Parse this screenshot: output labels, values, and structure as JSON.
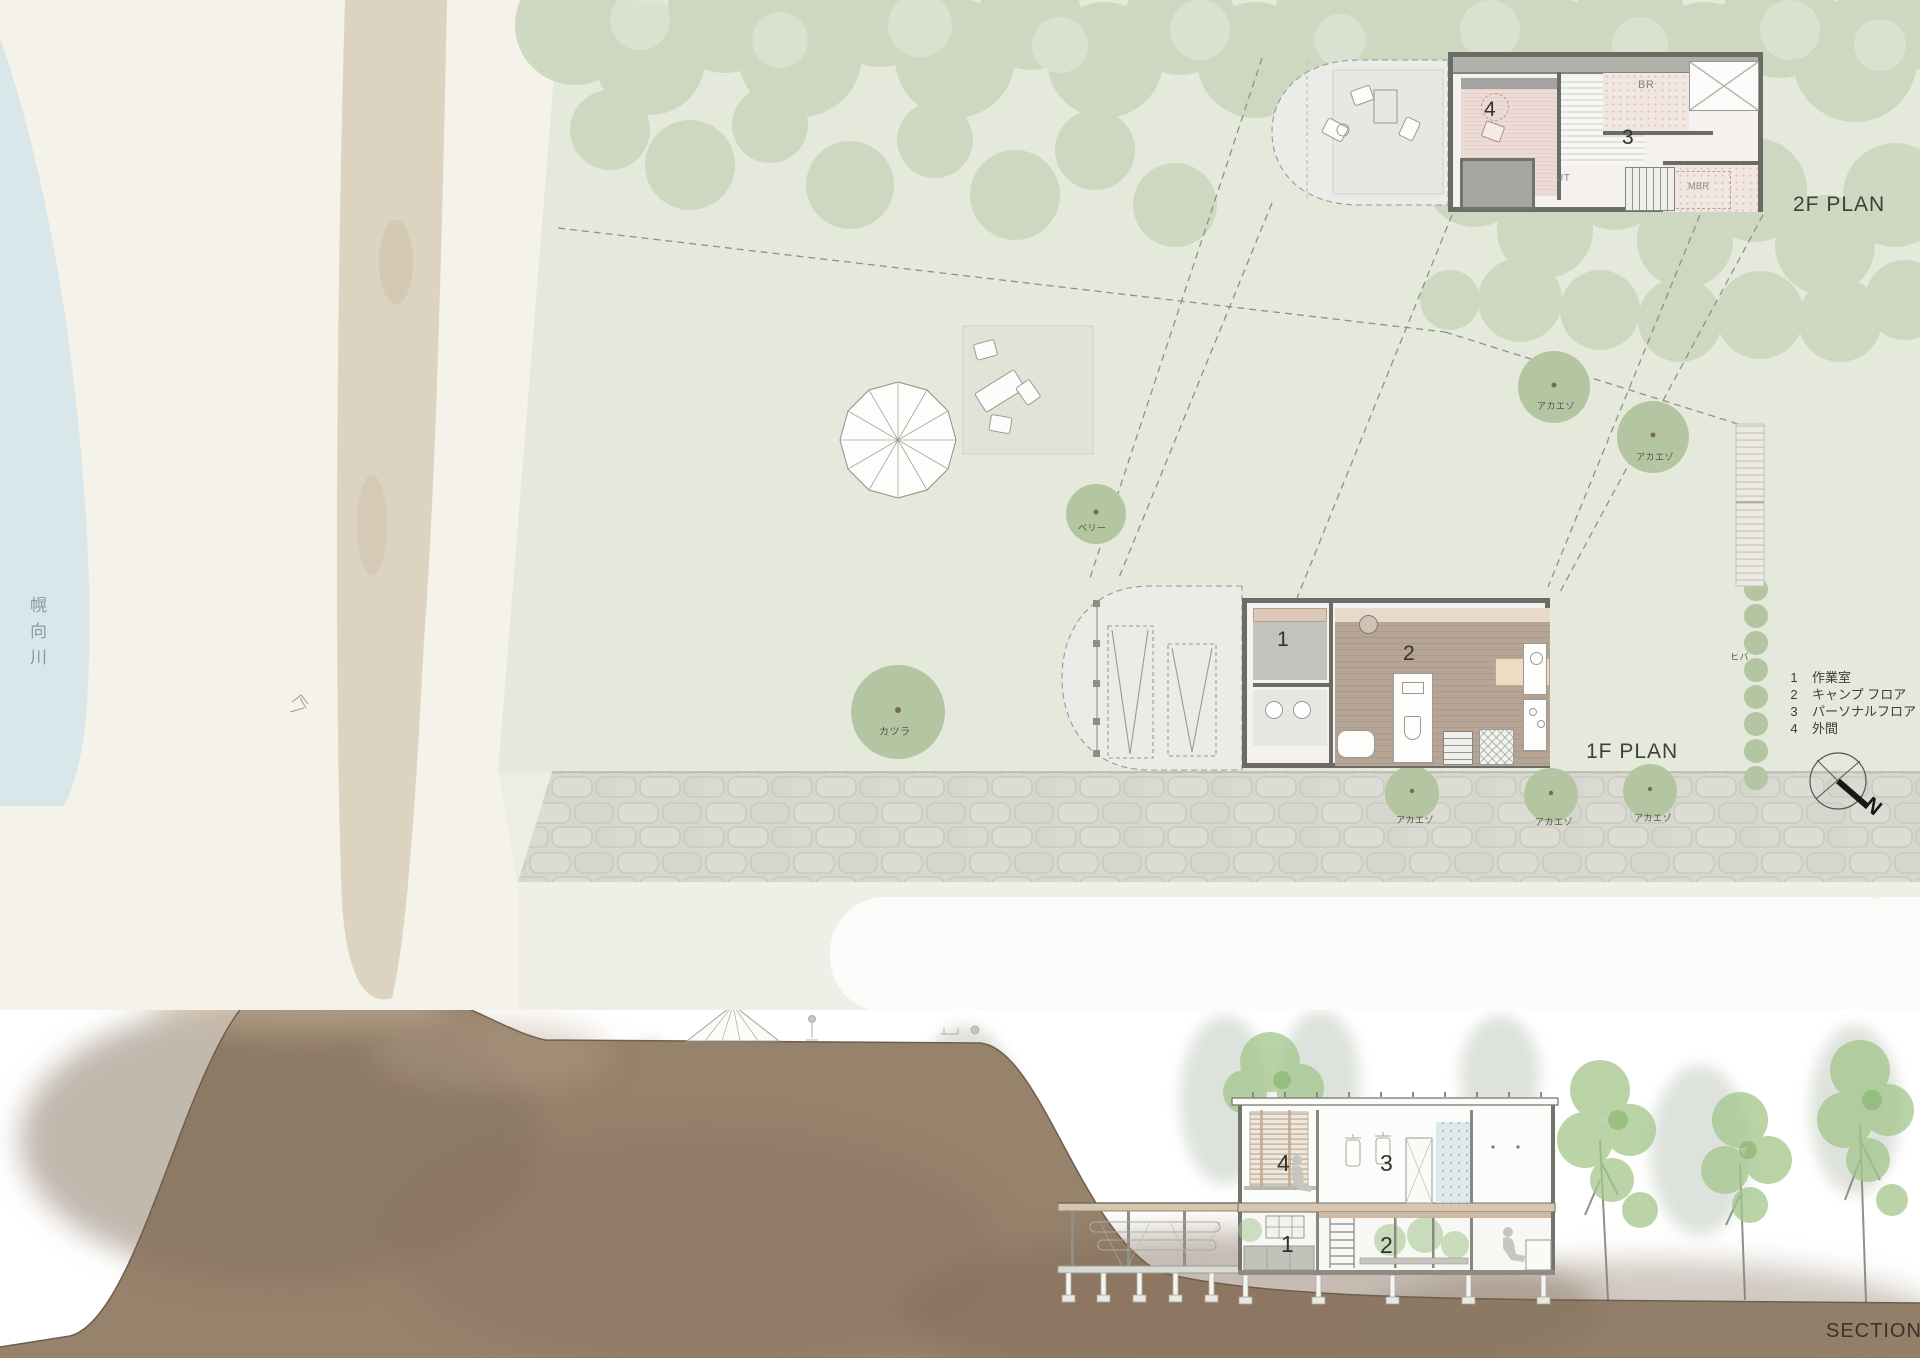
{
  "colors": {
    "river": "#d9e7eb",
    "bank": "#f5f3e9",
    "path": "#d9cfbb",
    "lawn": "#e5e9db",
    "canopy": "#cdd7bf",
    "tree": "#b4c5a1",
    "road": "#d6d7cf",
    "deck": "#ebebe8",
    "wall": "#6c6c66",
    "pink_floor": "#eddcd5",
    "wood_floor": "#b2a190",
    "ground": "#97826c",
    "ink": "#3b3b34"
  },
  "site_plan": {
    "river_name": "幌向川",
    "plan_2f_label": "2F PLAN",
    "plan_1f_label": "1F PLAN",
    "rooms_2f": {
      "n4": "4",
      "n3": "3",
      "br": "BR",
      "ut": "UT",
      "mbr": "MBR"
    },
    "rooms_1f": {
      "n1": "1",
      "n2": "2"
    },
    "trees": {
      "akaezo": "アカエゾ",
      "katsura": "カツラ",
      "berry": "ベリー",
      "hiba": "ヒバ"
    },
    "legend": [
      {
        "num": "1",
        "label": "作業室"
      },
      {
        "num": "2",
        "label": "キャンプ フロア"
      },
      {
        "num": "3",
        "label": "パーソナルフロア"
      },
      {
        "num": "4",
        "label": "外間"
      }
    ],
    "north": "N"
  },
  "section": {
    "label": "SECTION",
    "rooms": {
      "n1": "1",
      "n2": "2",
      "n3": "3",
      "n4": "4"
    }
  }
}
